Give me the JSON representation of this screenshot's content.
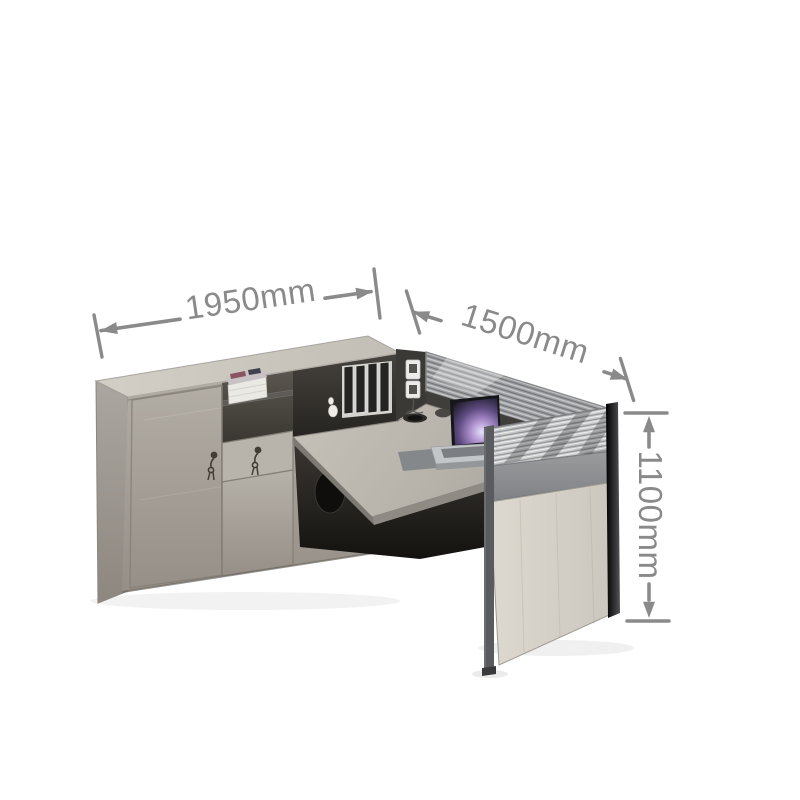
{
  "page": {
    "background_color": "#ffffff",
    "description": "Product photo of an L-shaped office workstation with dimension callouts"
  },
  "annotations": {
    "color": "#8a8a8a",
    "width": {
      "label": "1950mm"
    },
    "depth": {
      "label": "1500mm"
    },
    "height": {
      "label": "1100mm"
    }
  },
  "scene": {
    "parts": {
      "cabinet": "light grey sideboard with lockable door, drawer and open shelves",
      "shelf_items": "white books, small white ornament, four dark binders",
      "desk": "grey laminate desk return",
      "screen": "grey mesh privacy screen with dark rail",
      "side_panel": "light laminate end leg panel",
      "laptop": "silver laptop with purple wallpaper",
      "accessories": "power socket box, cable grommet, desk pad, mouse"
    },
    "colors": {
      "cabinet_wood": "#b3aea6",
      "cabinet_top": "#d0ccc4",
      "desk_surface": "#bab6ae",
      "screen_mesh": "#9c9da0",
      "screen_rail": "#403e3b",
      "frame_gray": "#595a5e",
      "side_panel_wood": "#d9d5cc",
      "under_desk_shadow": "#1c1a18",
      "laptop_screen": "#6f5694",
      "laptop_body": "#b4b7ba"
    }
  }
}
